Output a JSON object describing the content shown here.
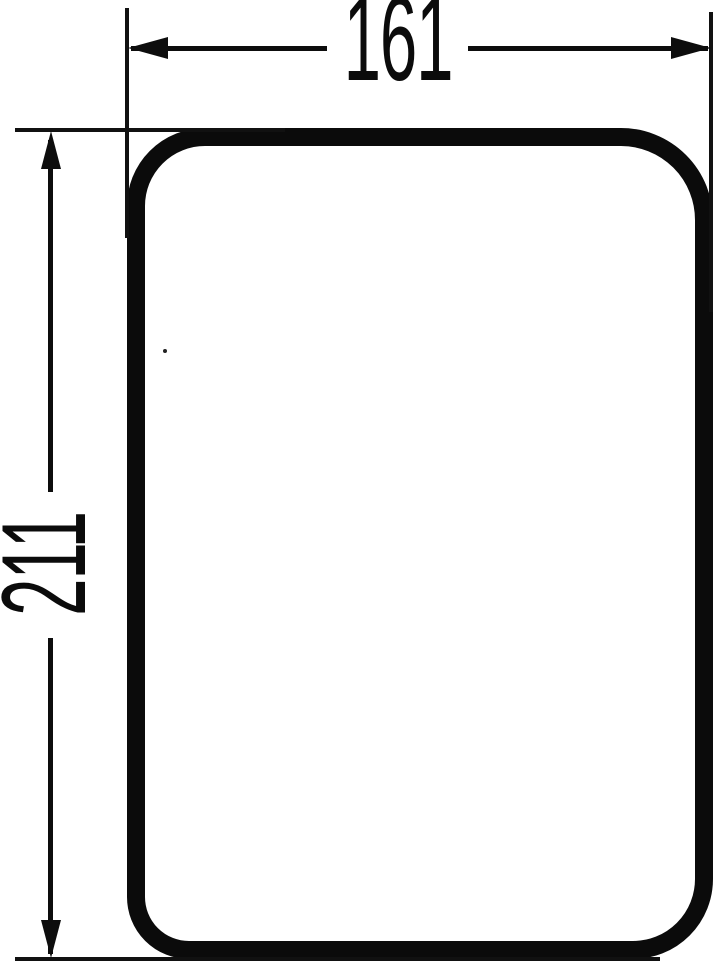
{
  "page": {
    "background_color": "#ffffff",
    "ink_color": "#0b0b0b"
  },
  "drawing": {
    "kind": "technical dimension drawing",
    "shape": "rounded rectangle outline",
    "width_dimension": {
      "value": "161",
      "orientation": "horizontal"
    },
    "height_dimension": {
      "value": "211",
      "orientation": "vertical"
    }
  }
}
